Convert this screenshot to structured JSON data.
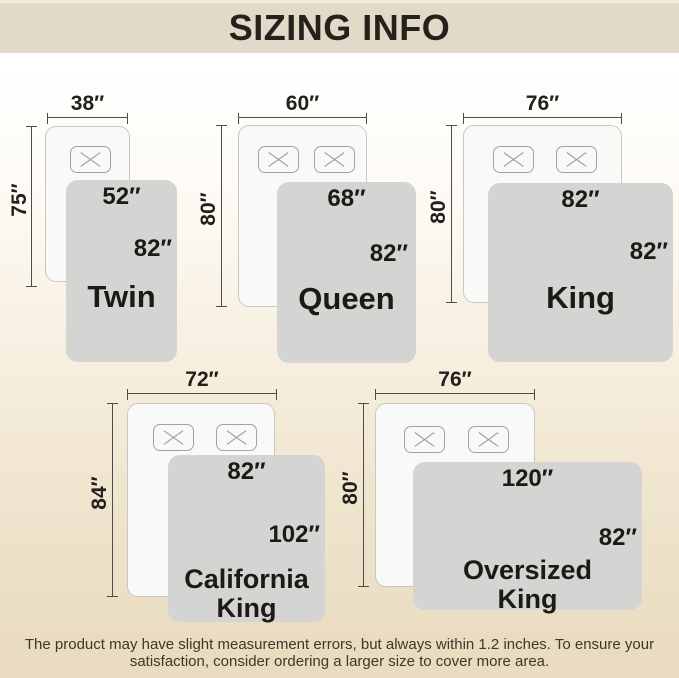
{
  "header": {
    "title": "SIZING INFO"
  },
  "sizes": [
    {
      "name_line1": "Twin",
      "bed_width": "38″",
      "bed_length": "75″",
      "blanket_top": "52″",
      "blanket_side": "82″"
    },
    {
      "name_line1": "Queen",
      "bed_width": "60″",
      "bed_length": "80″",
      "blanket_top": "68″",
      "blanket_side": "82″"
    },
    {
      "name_line1": "King",
      "bed_width": "76″",
      "bed_length": "80″",
      "blanket_top": "82″",
      "blanket_side": "82″"
    },
    {
      "name_line1": "California",
      "name_line2": "King",
      "bed_width": "72″",
      "bed_length": "84″",
      "blanket_top": "82″",
      "blanket_side": "102″"
    },
    {
      "name_line1": "Oversized",
      "name_line2": "King",
      "bed_width": "76″",
      "bed_length": "80″",
      "blanket_top": "120″",
      "blanket_side": "82″"
    }
  ],
  "footer": {
    "line1": "The product may have slight measurement errors, but always within 1.2 inches. To ensure your",
    "line2": "satisfaction, consider ordering a larger size to cover more area."
  },
  "colors": {
    "header_bg": "#e2d9c8",
    "page_bottom": "#e9dcc1",
    "blanket": "#d4d4d3",
    "bed": "#f9f9f8",
    "text": "#1d1a15"
  }
}
